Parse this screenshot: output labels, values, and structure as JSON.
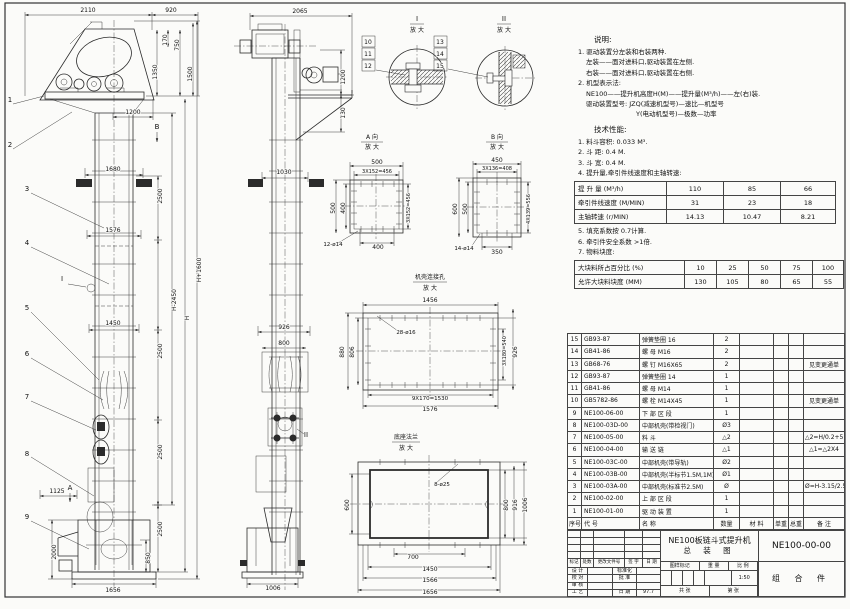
{
  "colors": {
    "paper": "#fbfbf9",
    "ink": "#2b2b2b"
  },
  "notes": {
    "title": "说明:",
    "items": [
      "1. 驱动装置分左装和右装两种.",
      "左装——面对进料口,驱动装置在左侧.",
      "右装——面对进料口,驱动装置在右侧.",
      "2. 机型表示法:",
      "NE100——提升机高度H(M)——提升量(M³/h)——左(右)装.",
      "驱动装置型号: JZQ(减速机型号)—速比—机型号",
      "Y(电动机型号)—极数—功率"
    ],
    "tech_title": "技术性能:",
    "tech_items": [
      "1. 料斗容积: 0.033 M³.",
      "2. 斗  距: 0.4 M.",
      "3. 斗  宽: 0.4 M.",
      "4. 提升量,牵引件线速度和主轴转速:"
    ],
    "tech_items2": [
      "5. 填充系数按 0.7计算.",
      "6. 牵引件安全系数 >1倍.",
      "7. 物料块度:"
    ]
  },
  "perf_table": {
    "rows": [
      [
        "提 升 量 (M³/h)",
        "110",
        "85",
        "66"
      ],
      [
        "牵引件线速度 (M/MIN)",
        "31",
        "23",
        "18"
      ],
      [
        "主轴转速 (r/MIN)",
        "14.13",
        "10.47",
        "8.21"
      ]
    ]
  },
  "lump_table": {
    "rows": [
      [
        "大块料所占百分比 (%)",
        "10",
        "25",
        "50",
        "75",
        "100"
      ],
      [
        "允许大块料块度 (MM)",
        "130",
        "105",
        "80",
        "65",
        "55"
      ]
    ]
  },
  "bom": {
    "rows": [
      [
        "15",
        "GB93-87",
        "弹簧垫圈 16",
        "2",
        "",
        "",
        "",
        ""
      ],
      [
        "14",
        "GB41-86",
        "螺  母 M16",
        "2",
        "",
        "",
        "",
        ""
      ],
      [
        "13",
        "GB68-76",
        "螺  钉 M16X65",
        "2",
        "",
        "",
        "",
        "见变更通单"
      ],
      [
        "12",
        "GB93-87",
        "弹簧垫圈 14",
        "1",
        "",
        "",
        "",
        ""
      ],
      [
        "11",
        "GB41-86",
        "螺  母 M14",
        "1",
        "",
        "",
        "",
        ""
      ],
      [
        "10",
        "GB5782-86",
        "螺  栓 M14X45",
        "1",
        "",
        "",
        "",
        "见变更通单"
      ],
      [
        "9",
        "NE100-06-00",
        "下 部 区 段",
        "1",
        "",
        "",
        "",
        ""
      ],
      [
        "8",
        "NE100-03D-00",
        "中部机壳(带检视门)",
        "Ø3",
        "",
        "",
        "",
        ""
      ],
      [
        "7",
        "NE100-05-00",
        "料  斗",
        "△2",
        "",
        "",
        "",
        "△2=H/0.2+5.75"
      ],
      [
        "6",
        "NE100-04-00",
        "输 送 链",
        "△1",
        "",
        "",
        "",
        "△1=△2X4"
      ],
      [
        "5",
        "NE100-03C-00",
        "中部机壳(带导轨)",
        "Ø2",
        "",
        "",
        "",
        ""
      ],
      [
        "4",
        "NE100-03B-00",
        "中部机壳(半标节1.5M,1M)",
        "Ø1",
        "",
        "",
        "",
        ""
      ],
      [
        "3",
        "NE100-03A-00",
        "中部机壳(标准节2.5M)",
        "Ø",
        "",
        "",
        "",
        "Ø=H-3.15/2.5"
      ],
      [
        "2",
        "NE100-02-00",
        "上 部 区 段",
        "1",
        "",
        "",
        "",
        ""
      ],
      [
        "1",
        "NE100-01-00",
        "驱 动 装 置",
        "1",
        "",
        "",
        "",
        ""
      ],
      [
        "序号",
        "代  号",
        "名  称",
        "数量",
        "材  料",
        "单重",
        "总重",
        "备  注"
      ]
    ]
  },
  "title_block": {
    "rev_row": [
      "标记",
      "处数",
      "更改文件号",
      "签 字",
      "日 期"
    ],
    "sig_rows": [
      [
        "设 计",
        "",
        "标准化",
        ""
      ],
      [
        "校 对",
        "",
        "批 准",
        ""
      ],
      [
        "审 核",
        "",
        "",
        ""
      ],
      [
        "工 艺",
        "",
        "日 期",
        "97.7"
      ]
    ],
    "stamp_header": [
      "图样标记",
      "重 量",
      "比 例"
    ],
    "scale": "1:50",
    "sheet_left": "共  张",
    "sheet_right": "第  张",
    "product_title_1": "NE100板链斗式提升机",
    "product_title_2": "总 装 图",
    "drawing_no": "NE100-00-00",
    "part_type": "组 合 件"
  },
  "drawing": {
    "labels": [
      [
        "2110",
        88,
        12
      ],
      [
        "920",
        171,
        12
      ],
      [
        "170",
        167,
        40,
        -90
      ],
      [
        "750",
        179,
        45,
        -90
      ],
      [
        "1350",
        157,
        72,
        -90
      ],
      [
        "1500",
        192,
        74,
        -90
      ],
      [
        "1200",
        133,
        114
      ],
      [
        "1680",
        113,
        171
      ],
      [
        "2500",
        162,
        196,
        -90
      ],
      [
        "1576",
        113,
        232
      ],
      [
        "H+1600",
        201,
        270,
        -90
      ],
      [
        "H-2450",
        176,
        300,
        -90
      ],
      [
        "H",
        189,
        318,
        -90
      ],
      [
        "1450",
        113,
        325
      ],
      [
        "2500",
        162,
        351,
        -90
      ],
      [
        "2500",
        162,
        452,
        -90
      ],
      [
        "2500",
        162,
        529,
        -90
      ],
      [
        "1125",
        57,
        493
      ],
      [
        "2000",
        56,
        552,
        -90
      ],
      [
        "850",
        150,
        558,
        -90
      ],
      [
        "1656",
        113,
        592
      ],
      [
        "1",
        10,
        102,
        0,
        7
      ],
      [
        "2",
        10,
        147,
        0,
        7
      ],
      [
        "3",
        27,
        191,
        0,
        7
      ],
      [
        "4",
        27,
        245,
        0,
        7
      ],
      [
        "5",
        27,
        310,
        0,
        7
      ],
      [
        "6",
        27,
        356,
        0,
        7
      ],
      [
        "7",
        27,
        399,
        0,
        7
      ],
      [
        "8",
        27,
        456,
        0,
        7
      ],
      [
        "9",
        27,
        519,
        0,
        7
      ],
      [
        "A",
        70,
        490,
        0,
        7
      ],
      [
        "B",
        157,
        129,
        0,
        7
      ],
      [
        "I",
        62,
        281,
        0,
        7
      ],
      [
        "2065",
        300,
        13
      ],
      [
        "1200",
        345,
        77,
        -90
      ],
      [
        "130",
        345,
        113,
        -90
      ],
      [
        "1030",
        284,
        174
      ],
      [
        "926",
        284,
        329
      ],
      [
        "800",
        284,
        345
      ],
      [
        "1006",
        273,
        590
      ],
      [
        "II",
        306,
        437,
        0,
        7
      ],
      [
        "I",
        417,
        21,
        0,
        7
      ],
      [
        "放 大",
        417,
        32
      ],
      [
        "10",
        368,
        44
      ],
      [
        "11",
        368,
        56
      ],
      [
        "12",
        368,
        68
      ],
      [
        "II",
        504,
        21,
        0,
        7
      ],
      [
        "放 大",
        504,
        32
      ],
      [
        "13",
        440,
        44
      ],
      [
        "14",
        440,
        56
      ],
      [
        "15",
        440,
        68
      ],
      [
        "A 向",
        372,
        139
      ],
      [
        "放 大",
        372,
        149
      ],
      [
        "500",
        377,
        164
      ],
      [
        "3X152=456",
        377,
        173,
        0,
        5
      ],
      [
        "500",
        335,
        208,
        -90
      ],
      [
        "400",
        345,
        208,
        -90
      ],
      [
        "3X152=456",
        410,
        208,
        -90,
        5
      ],
      [
        "12-ø14",
        333,
        246,
        0,
        5.5
      ],
      [
        "400",
        378,
        249
      ],
      [
        "B 向",
        497,
        139
      ],
      [
        "放 大",
        497,
        149
      ],
      [
        "450",
        497,
        162
      ],
      [
        "3X136=408",
        497,
        170,
        0,
        5
      ],
      [
        "600",
        457,
        209,
        -90
      ],
      [
        "500",
        467,
        209,
        -90
      ],
      [
        "4X139=556",
        530,
        209,
        -90,
        5
      ],
      [
        "14-ø14",
        464,
        250,
        0,
        5.5
      ],
      [
        "350",
        497,
        254
      ],
      [
        "机壳连接孔",
        430,
        279
      ],
      [
        "放 大",
        430,
        290
      ],
      [
        "1456",
        430,
        302
      ],
      [
        "28-ø16",
        406,
        334,
        0,
        5.5
      ],
      [
        "880",
        344,
        352,
        -90
      ],
      [
        "806",
        354,
        352,
        -90
      ],
      [
        "3X180=540",
        506,
        351,
        -90,
        5
      ],
      [
        "926",
        517,
        352,
        -90
      ],
      [
        "9X170=1530",
        430,
        400,
        0,
        5.5
      ],
      [
        "1576",
        430,
        411
      ],
      [
        "底座法兰",
        406,
        439
      ],
      [
        "放 大",
        406,
        450
      ],
      [
        "8-ø25",
        442,
        486,
        0,
        5.5
      ],
      [
        "600",
        349,
        505,
        -90
      ],
      [
        "800",
        508,
        505,
        -90
      ],
      [
        "916",
        517,
        505,
        -90
      ],
      [
        "1006",
        527,
        505,
        -90
      ],
      [
        "700",
        413,
        559
      ],
      [
        "1450",
        430,
        571
      ],
      [
        "1566",
        430,
        582
      ],
      [
        "1656",
        430,
        594
      ]
    ]
  }
}
